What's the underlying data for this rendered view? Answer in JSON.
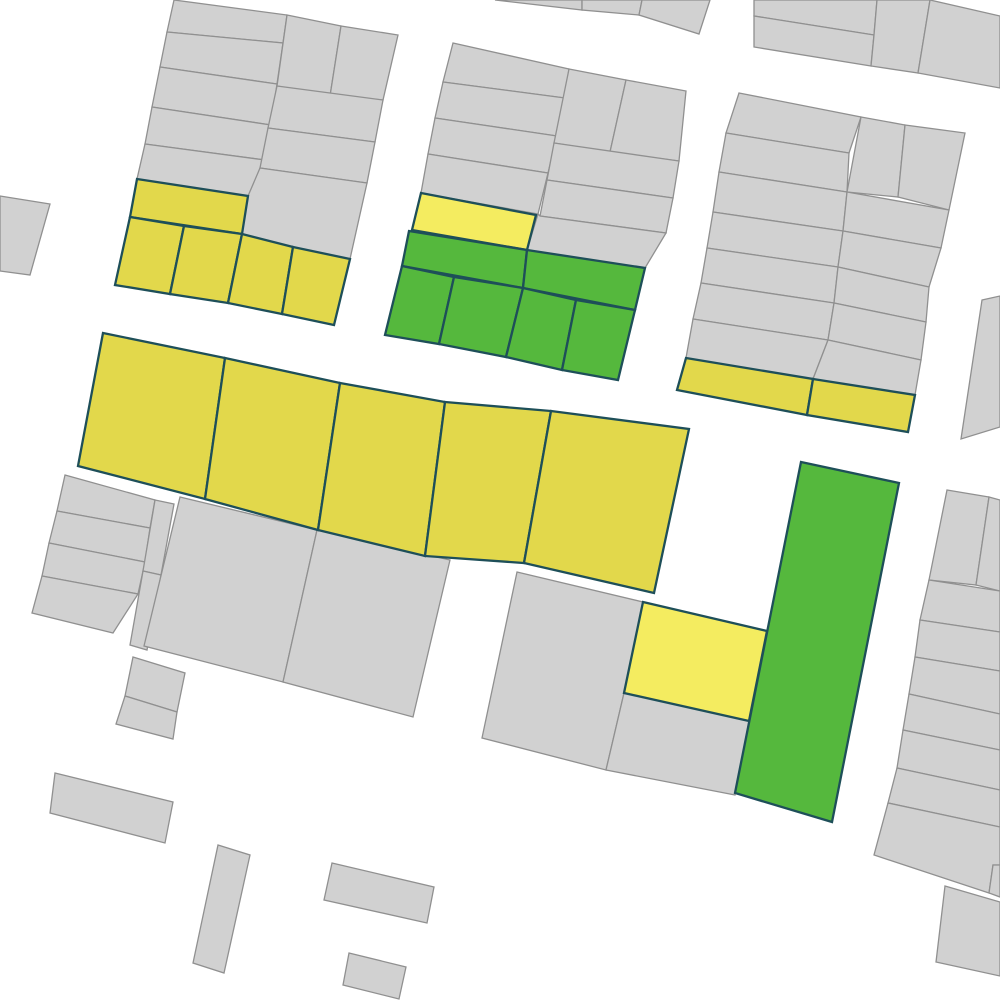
{
  "map": {
    "width": 1000,
    "height": 1000,
    "background": "#ffffff",
    "colors": {
      "gray_fill": "#d1d1d1",
      "gray_stroke": "#909090",
      "yellow_fill": "#e2d84b",
      "bright_yellow_fill": "#f4ec60",
      "green_fill": "#55b83d",
      "colored_stroke": "#1e4f59"
    },
    "stroke_widths": {
      "gray": 1.3,
      "colored": 2.3
    },
    "parcels": [
      {
        "id": "top-sliver-1",
        "fill": "gray",
        "points": "495,0 582,0 582,10"
      },
      {
        "id": "top-sliver-2",
        "fill": "gray",
        "points": "582,0 642,0 639,15 582,10"
      },
      {
        "id": "top-sliver-3",
        "fill": "gray",
        "points": "642,0 710,0 699,34 639,15"
      },
      {
        "id": "topright-a",
        "fill": "gray",
        "points": "754,0 877,0 874,35 754,16"
      },
      {
        "id": "topright-b",
        "fill": "gray",
        "points": "754,16 874,35 871,66 754,47"
      },
      {
        "id": "topright-c",
        "fill": "gray",
        "points": "877,0 930,0 918,73 871,66 874,35"
      },
      {
        "id": "topright-d",
        "fill": "gray",
        "points": "930,0 1000,16 1000,88 918,73"
      },
      {
        "id": "blockA-l1",
        "fill": "gray",
        "points": "174,0 287,15 283,43 167,32"
      },
      {
        "id": "blockA-l2",
        "fill": "gray",
        "points": "167,32 283,43 277,84 160,67"
      },
      {
        "id": "blockA-l3",
        "fill": "gray",
        "points": "160,67 277,84 271,125 152,107"
      },
      {
        "id": "blockA-l4",
        "fill": "gray",
        "points": "152,107 271,125 265,160 145,144"
      },
      {
        "id": "blockA-l5",
        "fill": "gray",
        "points": "145,144 265,160 250,197 137,179"
      },
      {
        "id": "blockA-t1",
        "fill": "gray",
        "points": "287,15 341,26 330,96 277,86"
      },
      {
        "id": "blockA-t2",
        "fill": "gray",
        "points": "341,26 398,35 383,100 330,96"
      },
      {
        "id": "blockA-r1",
        "fill": "gray",
        "points": "277,86 383,100 375,142 268,128"
      },
      {
        "id": "blockA-r2",
        "fill": "gray",
        "points": "268,128 375,142 367,183 260,168"
      },
      {
        "id": "blockA-r3",
        "fill": "gray",
        "points": "260,168 367,183 350,259 293,247 242,234 248,196"
      },
      {
        "id": "left-edge",
        "fill": "gray",
        "points": "0,196 50,204 30,275 0,271"
      },
      {
        "id": "blockB-l1",
        "fill": "gray",
        "points": "453,43 569,69 565,98 443,82"
      },
      {
        "id": "blockB-l2",
        "fill": "gray",
        "points": "443,82 565,98 557,136 435,118"
      },
      {
        "id": "blockB-l3",
        "fill": "gray",
        "points": "435,118 557,136 548,173 428,154"
      },
      {
        "id": "blockB-l4",
        "fill": "gray",
        "points": "428,154 548,173 538,214 421,193"
      },
      {
        "id": "blockB-t1",
        "fill": "gray",
        "points": "569,69 626,80 610,152 554,143"
      },
      {
        "id": "blockB-t2",
        "fill": "gray",
        "points": "626,80 686,91 679,161 610,152"
      },
      {
        "id": "blockB-r1",
        "fill": "gray",
        "points": "554,143 679,161 673,198 547,180"
      },
      {
        "id": "blockB-r2",
        "fill": "gray",
        "points": "547,180 673,198 666,233 540,216"
      },
      {
        "id": "blockB-r3",
        "fill": "gray",
        "points": "538,214 540,216 666,233 645,268 527,250"
      },
      {
        "id": "blockC-l1",
        "fill": "gray",
        "points": "739,93 861,117 849,153 726,133"
      },
      {
        "id": "blockC-l2",
        "fill": "gray",
        "points": "726,133 849,153 847,192 719,172"
      },
      {
        "id": "blockC-l3",
        "fill": "gray",
        "points": "719,172 847,192 843,231 713,212"
      },
      {
        "id": "blockC-l4",
        "fill": "gray",
        "points": "713,212 843,231 838,267 707,248"
      },
      {
        "id": "blockC-l5",
        "fill": "gray",
        "points": "707,248 838,267 834,303 701,283"
      },
      {
        "id": "blockC-l6",
        "fill": "gray",
        "points": "701,283 834,303 828,340 693,319"
      },
      {
        "id": "blockC-l7",
        "fill": "gray",
        "points": "693,319 828,340 813,379 686,358"
      },
      {
        "id": "blockC-t1",
        "fill": "gray",
        "points": "861,117 905,125 898,197 847,192"
      },
      {
        "id": "blockC-t2",
        "fill": "gray",
        "points": "905,125 965,133 949,210 898,197"
      },
      {
        "id": "blockC-r1",
        "fill": "gray",
        "points": "847,192 949,210 941,248 843,231"
      },
      {
        "id": "blockC-r2",
        "fill": "gray",
        "points": "843,231 941,248 929,287 838,267"
      },
      {
        "id": "blockC-r3",
        "fill": "gray",
        "points": "838,267 929,287 926,322 834,303"
      },
      {
        "id": "blockC-r4",
        "fill": "gray",
        "points": "834,303 926,322 921,360 828,340"
      },
      {
        "id": "blockC-r5",
        "fill": "gray",
        "points": "828,340 921,360 915,395 813,379"
      },
      {
        "id": "blockF-s1",
        "fill": "gray",
        "points": "65,475 155,500 150,528 57,511"
      },
      {
        "id": "blockF-s2",
        "fill": "gray",
        "points": "57,511 150,528 145,562 49,543"
      },
      {
        "id": "blockF-s3",
        "fill": "gray",
        "points": "49,543 145,562 138,594 42,576"
      },
      {
        "id": "blockF-s4",
        "fill": "gray",
        "points": "42,576 138,594 113,633 32,613"
      },
      {
        "id": "blockF-n1",
        "fill": "gray",
        "points": "155,500 174,504 161,575 143,571"
      },
      {
        "id": "blockF-n2",
        "fill": "gray",
        "points": "143,571 161,575 147,650 130,645"
      },
      {
        "id": "blockF-big-left",
        "fill": "gray",
        "points": "180,497 317,530 283,682 144,646"
      },
      {
        "id": "blockF-big-right",
        "fill": "gray",
        "points": "317,530 450,560 413,717 283,682"
      },
      {
        "id": "blockF-small-a",
        "fill": "gray",
        "points": "133,657 185,673 177,712 125,696"
      },
      {
        "id": "blockF-small-b",
        "fill": "gray",
        "points": "125,696 177,712 173,739 116,724"
      },
      {
        "id": "blockG-gray-left",
        "fill": "gray",
        "points": "517,572 643,602 624,693 606,770 482,738"
      },
      {
        "id": "blockG-gray-bottom",
        "fill": "gray",
        "points": "624,693 749,721 735,795 606,770"
      },
      {
        "id": "right-upper",
        "fill": "gray",
        "points": "982,300 1000,296 1000,427 961,439"
      },
      {
        "id": "blockH-t1",
        "fill": "gray",
        "points": "947,490 989,497 976,585 929,580"
      },
      {
        "id": "blockH-t2",
        "fill": "gray",
        "points": "989,497 1000,500 1000,591 976,585"
      },
      {
        "id": "blockH-s1",
        "fill": "gray",
        "points": "929,580 1000,591 1000,632 920,620"
      },
      {
        "id": "blockH-s2",
        "fill": "gray",
        "points": "920,620 1000,632 1000,671 915,657"
      },
      {
        "id": "blockH-s3",
        "fill": "gray",
        "points": "915,657 1000,671 1000,714 909,694"
      },
      {
        "id": "blockH-s4",
        "fill": "gray",
        "points": "909,694 1000,714 1000,750 903,730"
      },
      {
        "id": "blockH-s5",
        "fill": "gray",
        "points": "903,730 1000,750 1000,790 897,768"
      },
      {
        "id": "blockH-s6",
        "fill": "gray",
        "points": "897,768 1000,790 1000,827 888,803"
      },
      {
        "id": "blockH-s7",
        "fill": "gray",
        "points": "888,803 1000,827 1000,865 993,865 989,893 874,855"
      },
      {
        "id": "blockH-corner",
        "fill": "gray",
        "points": "993,865 1000,865 1000,897 989,893"
      },
      {
        "id": "corner-bottom-right",
        "fill": "gray",
        "points": "945,886 1000,902 1000,976 936,962"
      },
      {
        "id": "small-rect-1",
        "fill": "gray",
        "points": "55,773 173,802 165,843 50,813"
      },
      {
        "id": "small-rect-2",
        "fill": "gray",
        "points": "218,845 250,855 224,973 193,963"
      },
      {
        "id": "small-rect-3",
        "fill": "gray",
        "points": "332,863 434,887 427,923 324,900"
      },
      {
        "id": "small-rect-4",
        "fill": "gray",
        "points": "349,953 406,967 399,999 343,985"
      },
      {
        "id": "blockA-yellow-strip",
        "fill": "yellow",
        "points": "137,179 248,196 242,234 130,217"
      },
      {
        "id": "blockA-yellow-1",
        "fill": "yellow",
        "points": "130,217 184,226 170,294 115,285"
      },
      {
        "id": "blockA-yellow-2",
        "fill": "yellow",
        "points": "184,226 242,234 228,303 170,294"
      },
      {
        "id": "blockA-yellow-3",
        "fill": "yellow",
        "points": "242,234 293,247 282,314 228,303"
      },
      {
        "id": "blockA-yellow-4",
        "fill": "yellow",
        "points": "293,247 350,259 334,325 282,314"
      },
      {
        "id": "blockC-yellow-1",
        "fill": "yellow",
        "points": "686,358 813,379 807,415 677,390"
      },
      {
        "id": "blockC-yellow-2",
        "fill": "yellow",
        "points": "813,379 915,395 908,432 807,415"
      },
      {
        "id": "blockE-yellow-1",
        "fill": "yellow",
        "points": "103,333 225,358 205,499 78,466"
      },
      {
        "id": "blockE-yellow-2",
        "fill": "yellow",
        "points": "225,358 340,383 318,530 205,499"
      },
      {
        "id": "blockE-yellow-3",
        "fill": "yellow",
        "points": "340,383 445,402 425,556 318,530"
      },
      {
        "id": "blockE-yellow-4",
        "fill": "yellow",
        "points": "445,402 551,411 524,563 425,556"
      },
      {
        "id": "blockE-yellow-5",
        "fill": "yellow",
        "points": "551,411 689,429 654,593 524,563"
      },
      {
        "id": "blockB-bright-yellow",
        "fill": "bright_yellow",
        "points": "421,193 536,215 527,250 412,230"
      },
      {
        "id": "blockG-bright-yellow",
        "fill": "bright_yellow",
        "points": "643,602 767,631 749,721 624,693"
      },
      {
        "id": "blockB-green-strip-left",
        "fill": "green",
        "points": "409,231 527,250 523,288 402,266"
      },
      {
        "id": "blockB-green-strip-right",
        "fill": "green",
        "points": "527,250 645,268 635,310 523,288"
      },
      {
        "id": "blockB-green-1",
        "fill": "green",
        "points": "402,266 454,277 439,344 385,335"
      },
      {
        "id": "blockB-green-2",
        "fill": "green",
        "points": "454,277 523,288 506,357 439,344"
      },
      {
        "id": "blockB-green-3",
        "fill": "green",
        "points": "523,288 576,300 562,370 506,357"
      },
      {
        "id": "blockB-green-4",
        "fill": "green",
        "points": "576,300 635,310 618,380 562,370"
      },
      {
        "id": "blockG-green-tall",
        "fill": "green",
        "points": "801,462 899,483 832,822 735,793"
      }
    ]
  }
}
